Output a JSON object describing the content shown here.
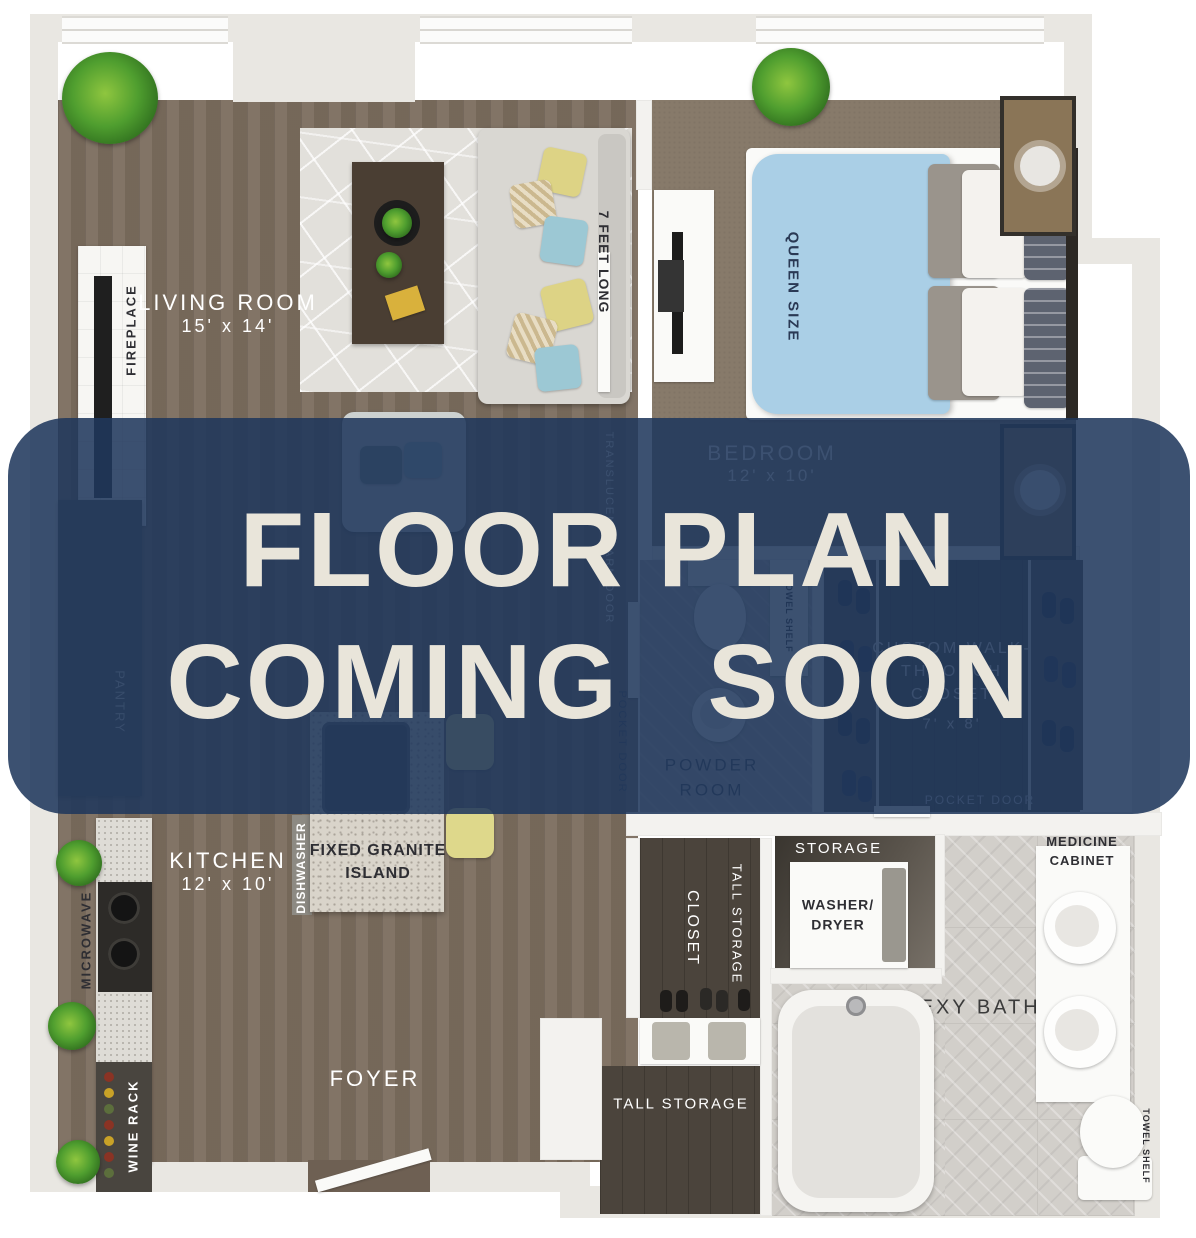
{
  "overlay": {
    "line1": "FLOOR PLAN",
    "line2": "COMING SOON",
    "banner_color": "#1f375c",
    "text_color": "#e9e5da"
  },
  "rooms": {
    "living_room_name": "LIVING ROOM",
    "living_room_dims": "15' x 14'",
    "bedroom_name": "BEDROOM",
    "bedroom_dims": "12' x 10'",
    "kitchen_name": "KITCHEN",
    "kitchen_dims": "12' x 10'",
    "foyer": "FOYER",
    "powder_room": "POWDER ROOM",
    "closet": "CLOSET",
    "tall_storage_closet": "TALL STORAGE",
    "tall_storage_lower": "TALL STORAGE",
    "walk_closet_name": "CUSTOM WALK-THROUGH CLOSET",
    "walk_closet_dims": "7' x 8'",
    "sexy_bath": "SEXY BATH",
    "storage": "STORAGE"
  },
  "features": {
    "fireplace": "FIREPLACE",
    "pantry": "PANTRY",
    "microwave": "MICROWAVE",
    "wine_rack": "WINE RACK",
    "dishwasher": "DISHWASHER",
    "granite_island": "FIXED GRANITE ISLAND",
    "queen_size": "QUEEN SIZE",
    "sofa_length": "7 FEET LONG",
    "barn_door": "TRANSLUCENT BARN DOOR",
    "pocket_door_powder": "POCKET DOOR",
    "pocket_door_closet": "POCKET DOOR",
    "towel_shelf_powder": "TOWEL SHELF",
    "towel_shelf_bath": "TOWEL SHELF",
    "washer_dryer": "WASHER/ DRYER",
    "medicine_cabinet": "MEDICINE CABINET"
  },
  "colors": {
    "banner": "#1f375c",
    "banner_text": "#e9e5da",
    "wood_floor": "#7b6d5e",
    "bedroom_carpet": "#877a6a",
    "dark_closet_floor": "#4b443c",
    "bath_tile": "#d2cfca",
    "powder_tile": "#b7b3ae",
    "wall_light": "#e9e7e2",
    "duvet_blue": "#aacfe6",
    "cushion_yellow": "#ddd385",
    "cushion_teal": "#9cc8d4"
  }
}
